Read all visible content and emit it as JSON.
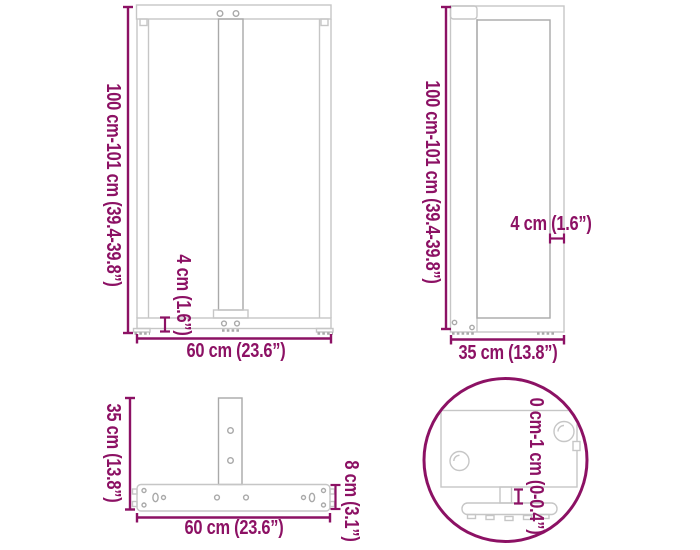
{
  "diagram": {
    "title": "T-shaped table leg dimensions diagram",
    "views": {
      "front": {
        "height_label": "100 cm-101 cm (39.4-39.8”)",
        "width_label": "60 cm (23.6”)",
        "thickness_label": "4 cm (1.6”)"
      },
      "side": {
        "height_label": "100 cm-101 cm (39.4-39.8”)",
        "depth_label": "35 cm (13.8”)",
        "thickness_label": "4 cm (1.6”)"
      },
      "base_top": {
        "depth_label": "35 cm (13.8”)",
        "width_label": "60 cm (23.6”)",
        "bar_width_label": "8 cm (3.1”)"
      },
      "foot_detail": {
        "adjustable_height_label": "0 cm-1 cm (0-0.4”)"
      }
    },
    "colors": {
      "dimension_accent": "#8c1164",
      "drawing_line": "#c6c6c6",
      "drawing_line_dark": "#a9a9a9",
      "background": "#ffffff"
    }
  }
}
